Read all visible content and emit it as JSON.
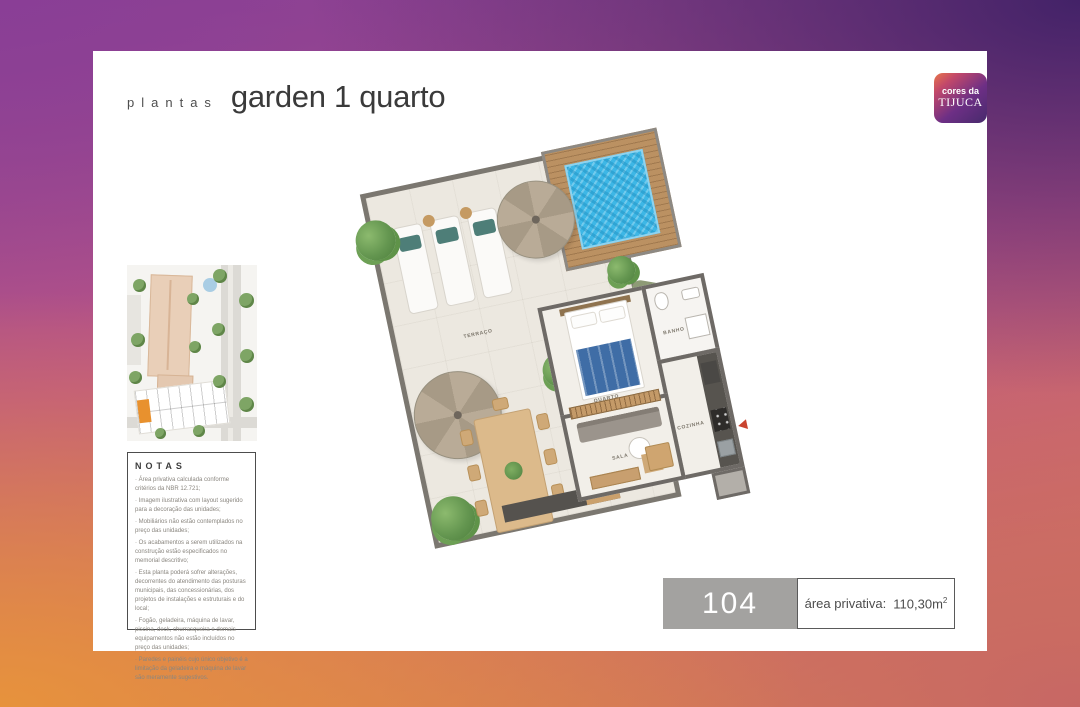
{
  "header": {
    "eyebrow": "plantas",
    "title": "garden 1 quarto"
  },
  "logo": {
    "line1": "cores da",
    "line2": "TIJUCA"
  },
  "notes": {
    "title": "NOTAS",
    "items": [
      "Área privativa calculada conforme critérios da NBR 12.721;",
      "Imagem ilustrativa com layout sugerido para a decoração das unidades;",
      "Mobiliários não estão contemplados no preço das unidades;",
      "Os acabamentos a serem utilizados na construção estão especificados no memorial descritivo;",
      "Esta planta poderá sofrer alterações, decorrentes do atendimento das posturas municipais, das concessionárias, dos projetos de instalações e estruturais e do local;",
      "Fogão, geladeira, máquina de lavar, piscina, deck, churrasqueira e demais equipamentos não estão incluídos no preço das unidades;",
      "Paredes e painéis cujo único objetivo é a limitação da geladeira e máquina de lavar são meramente sugestivos."
    ]
  },
  "floorplan": {
    "labels": {
      "terraco": "TERRAÇO",
      "quarto": "QUARTO",
      "banho": "BANHO",
      "cozinha": "COZINHA",
      "sala": "SALA"
    }
  },
  "unit": {
    "number": "104",
    "area_label": "área privativa:",
    "area_value": "110,30m",
    "area_exponent": "2"
  },
  "colors": {
    "brand_purple": "#5d2e82",
    "brand_orange": "#e8764a",
    "badge_gray": "#a3a2a0",
    "highlighted_unit": "#e8912e",
    "pool_blue": "#3db7e6"
  }
}
